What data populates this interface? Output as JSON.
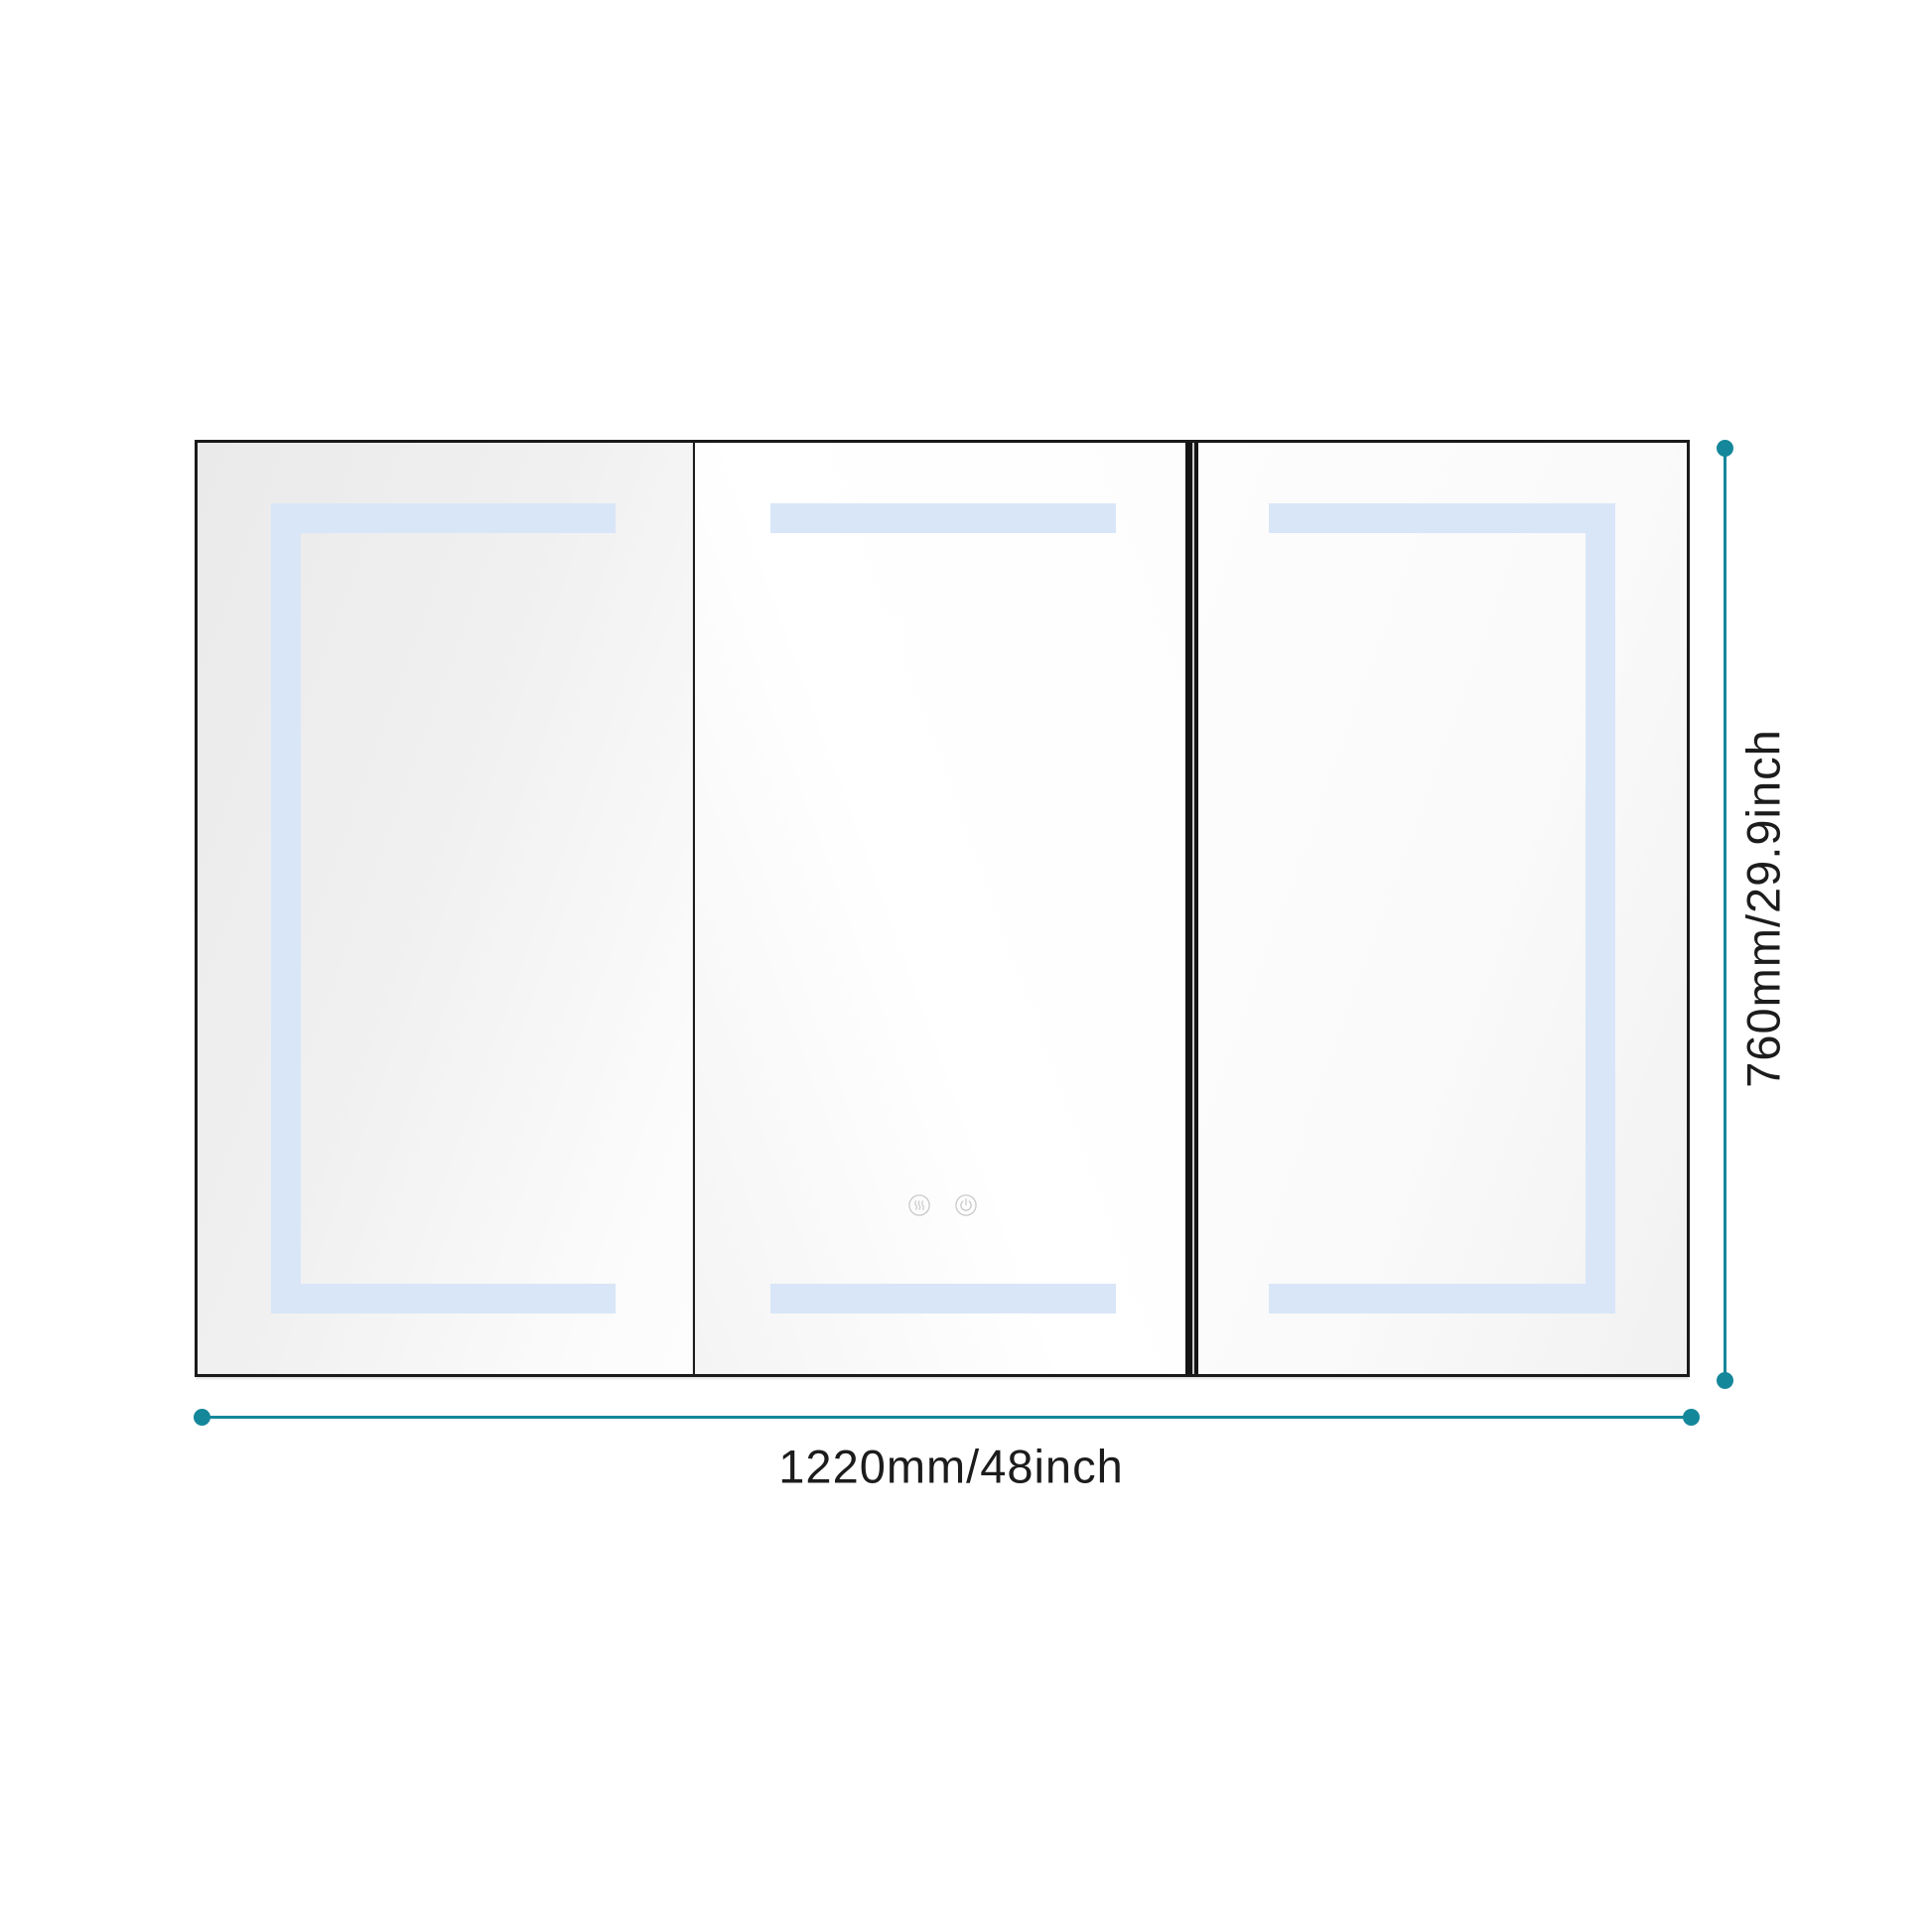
{
  "diagram": {
    "kind": "product-dimension-diagram",
    "subject": "three-door LED mirror medicine cabinet, front view"
  },
  "dimensions": {
    "width_label": "1220mm/48inch",
    "height_label": "760mm/29.9inch"
  },
  "doors": [
    {
      "position": "left",
      "led_shape": "top-left-bottom bracket"
    },
    {
      "position": "center",
      "led_shape": "top and bottom strips"
    },
    {
      "position": "right",
      "led_shape": "top-right-bottom bracket"
    }
  ],
  "controls": {
    "buttons": [
      {
        "icon": "defog-icon",
        "meaning": "anti-fog touch sensor"
      },
      {
        "icon": "power-icon",
        "meaning": "light on/off touch sensor"
      }
    ]
  },
  "colors": {
    "accent_teal": "#15879a",
    "led_blue": "#d9e6f8",
    "frame_black": "#1a1a1a",
    "text": "#1c1c1c",
    "touch_icon_gray": "#c9c9c9"
  }
}
